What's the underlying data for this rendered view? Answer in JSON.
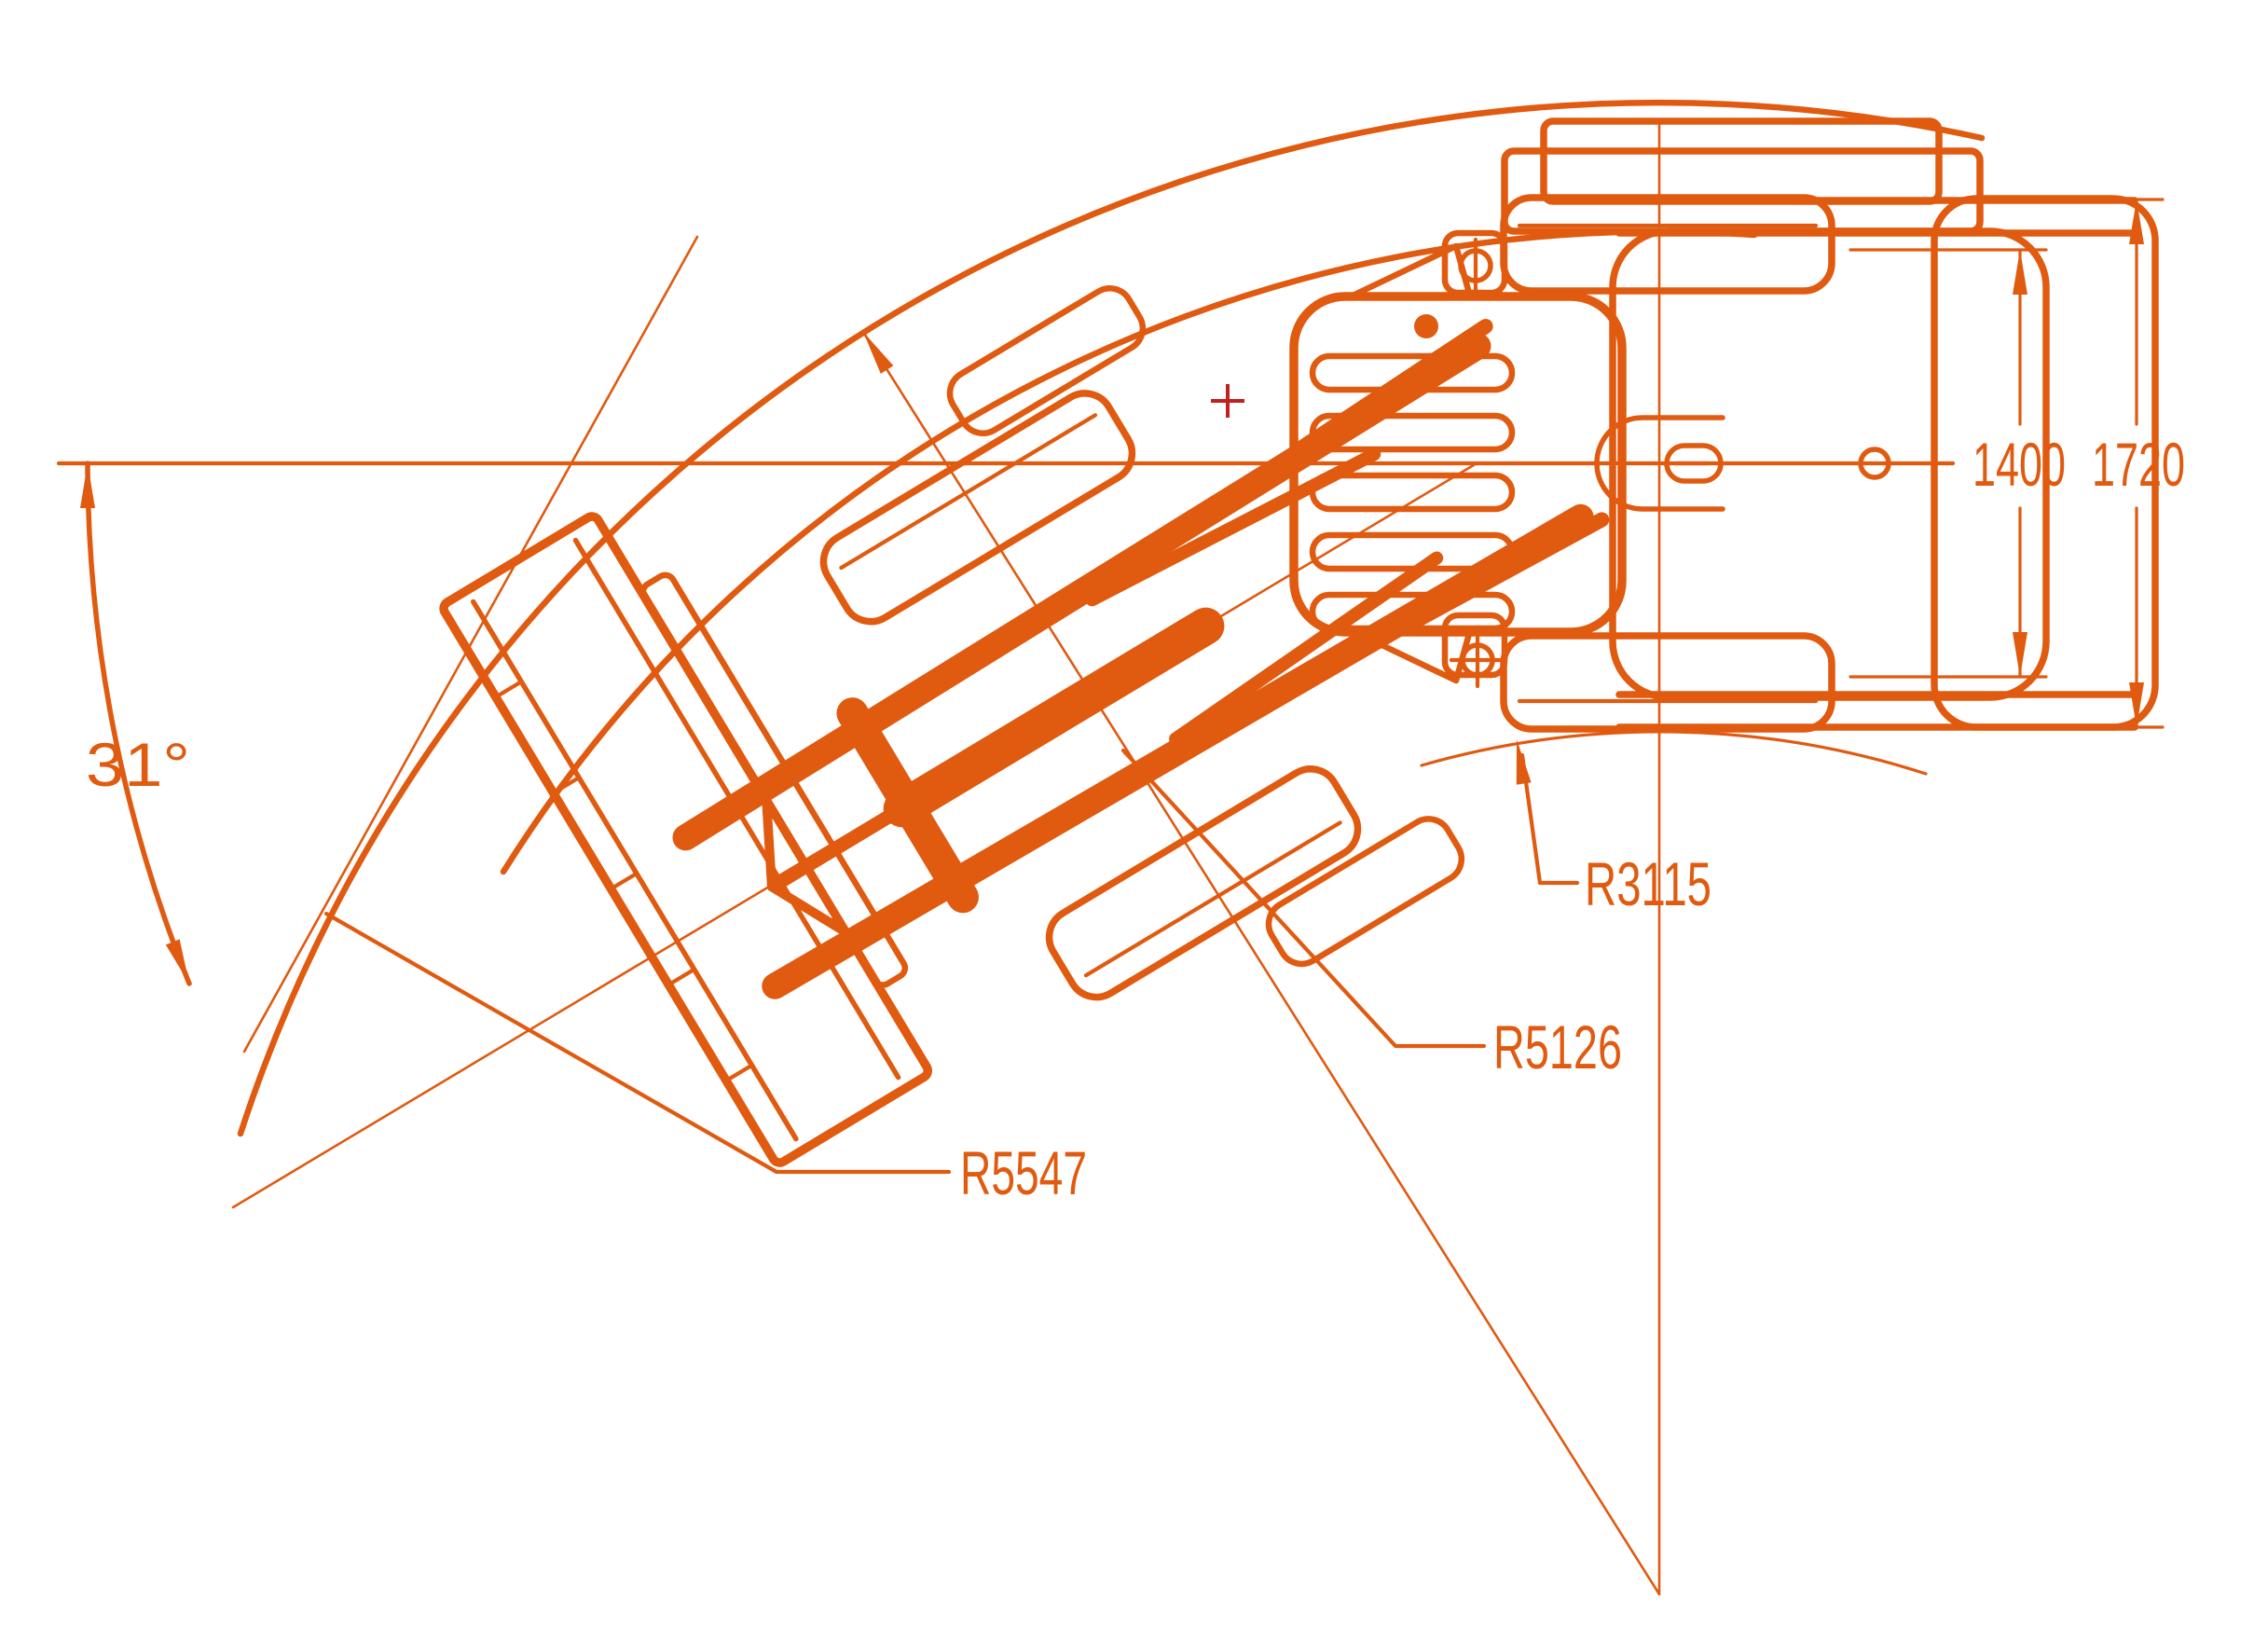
{
  "drawing": {
    "angle_label": "31°",
    "radius_labels": {
      "outer": "R5547",
      "mid": "R5126",
      "inner": "R3115"
    },
    "width_dims": {
      "track": "1400",
      "overall": "1720"
    },
    "colors": {
      "line": "#E05A10",
      "marker": "#C02020",
      "background": "#FFFFFF"
    }
  }
}
